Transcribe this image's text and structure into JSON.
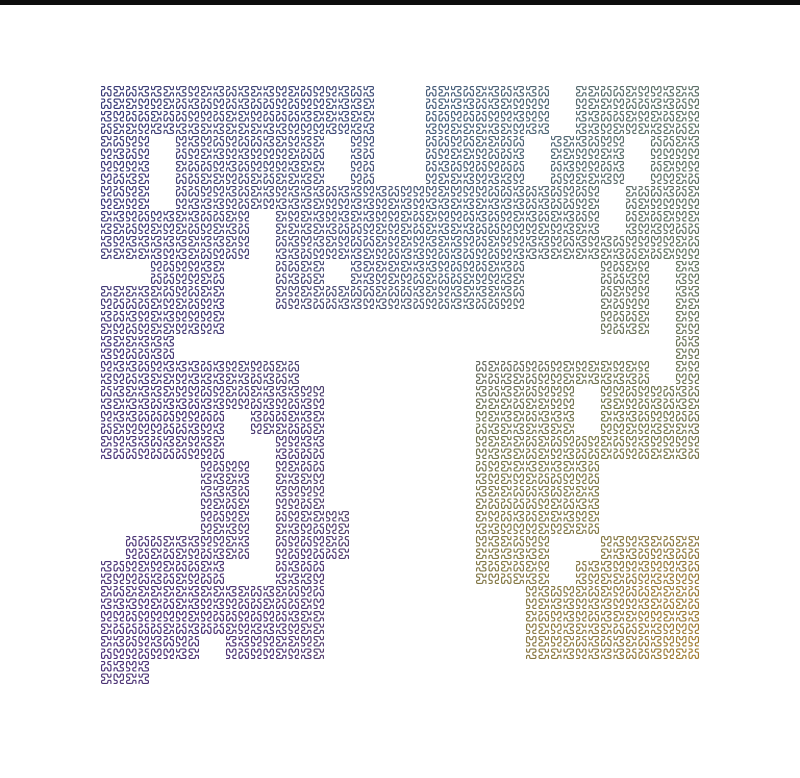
{
  "scene": {
    "description": "Space-filling fractal curve rendered with rounded-corner square meander motifs, colored along the path from purple and navy through steel blue and sage green to olive and gold, on a white background with a thin black strip across the top edge",
    "background_color": "#ffffff",
    "top_bar": {
      "color": "#0d0d0d",
      "height": 5,
      "width": 800
    }
  },
  "fractal": {
    "type": "rounded-corner meander curve (Hilbert-style motif tiles)",
    "origin_x": 100,
    "origin_y": 85,
    "cell_size": 25,
    "unit_size": 12.5,
    "stroke_width": 1.15,
    "corner_radius": 1.3,
    "motif_points": [
      [
        0,
        0
      ],
      [
        1,
        0
      ],
      [
        1,
        1
      ],
      [
        0,
        1
      ],
      [
        0,
        2
      ],
      [
        0,
        3
      ],
      [
        1,
        3
      ],
      [
        1,
        2
      ],
      [
        2,
        2
      ],
      [
        2,
        3
      ],
      [
        3,
        3
      ],
      [
        3,
        2
      ],
      [
        3,
        1
      ],
      [
        2,
        1
      ],
      [
        2,
        0
      ],
      [
        3,
        0
      ]
    ],
    "grid_rows": [
      "111111111110011111011111",
      "111111111110011111011111",
      "110111111010011110111011",
      "110111111010011110111011",
      "110111111111111111110111",
      "111111011111111111110111",
      "111111011111111111111111",
      "001110011011111110001101",
      "111110011111111110001101",
      "111110000000000000001101",
      "111000000000000000000001",
      "111111110000000111111101",
      "111111111000000111101111",
      "111110111000000111101111",
      "111110011000000111111111",
      "000011011000000111110000",
      "000011011000000111110000",
      "000011011100000111110000",
      "011111011100000111001111",
      "111110011000000111011111",
      "111111111000000001111111",
      "111111111000000001111111",
      "111101111000000001111111",
      "110000000000000000000000"
    ],
    "color_anchors": [
      {
        "x": 110,
        "y": 105,
        "c": "#313475"
      },
      {
        "x": 300,
        "y": 100,
        "c": "#353b78"
      },
      {
        "x": 365,
        "y": 120,
        "c": "#3a4a7c"
      },
      {
        "x": 450,
        "y": 115,
        "c": "#40617e"
      },
      {
        "x": 545,
        "y": 130,
        "c": "#4a6678"
      },
      {
        "x": 625,
        "y": 110,
        "c": "#5a7168"
      },
      {
        "x": 695,
        "y": 135,
        "c": "#5f7464"
      },
      {
        "x": 695,
        "y": 260,
        "c": "#60745f"
      },
      {
        "x": 660,
        "y": 360,
        "c": "#6b7857"
      },
      {
        "x": 620,
        "y": 408,
        "c": "#6c713f"
      },
      {
        "x": 610,
        "y": 455,
        "c": "#7d7c45"
      },
      {
        "x": 515,
        "y": 480,
        "c": "#7f7c44"
      },
      {
        "x": 505,
        "y": 540,
        "c": "#877e41"
      },
      {
        "x": 500,
        "y": 575,
        "c": "#887c3e"
      },
      {
        "x": 560,
        "y": 635,
        "c": "#97803a"
      },
      {
        "x": 620,
        "y": 500,
        "c": "#8a7c3b"
      },
      {
        "x": 665,
        "y": 590,
        "c": "#a87e2e"
      },
      {
        "x": 700,
        "y": 655,
        "c": "#ad7f27"
      },
      {
        "x": 110,
        "y": 200,
        "c": "#37327a"
      },
      {
        "x": 110,
        "y": 350,
        "c": "#3e2f7a"
      },
      {
        "x": 118,
        "y": 490,
        "c": "#462c7d"
      },
      {
        "x": 130,
        "y": 630,
        "c": "#4b2c7c"
      },
      {
        "x": 180,
        "y": 610,
        "c": "#412673"
      },
      {
        "x": 265,
        "y": 640,
        "c": "#482a78"
      },
      {
        "x": 320,
        "y": 560,
        "c": "#452b79"
      },
      {
        "x": 300,
        "y": 430,
        "c": "#402973"
      },
      {
        "x": 180,
        "y": 410,
        "c": "#3b2570"
      },
      {
        "x": 230,
        "y": 300,
        "c": "#3c3278"
      },
      {
        "x": 355,
        "y": 250,
        "c": "#41497e"
      },
      {
        "x": 455,
        "y": 262,
        "c": "#42607e"
      },
      {
        "x": 460,
        "y": 225,
        "c": "#3e5876"
      },
      {
        "x": 480,
        "y": 430,
        "c": "#6f7a50"
      }
    ]
  }
}
